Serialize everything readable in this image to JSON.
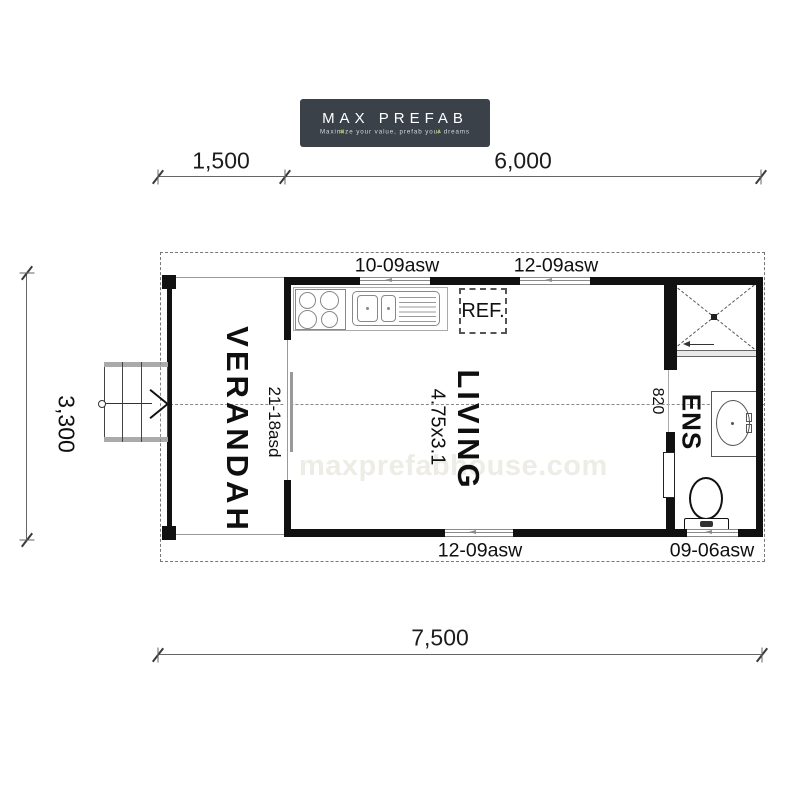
{
  "logo": {
    "title": "MAX PREFAB",
    "tagline": "Maximize your value, prefab your dreams",
    "bg_color": "#3a4149",
    "text_color": "#ffffff",
    "accent_color": "#8fc73e"
  },
  "dimensions": {
    "top_left": "1,500",
    "top_right": "6,000",
    "left_side": "3,300",
    "bottom": "7,500"
  },
  "rooms": {
    "verandah": "VERANDAH",
    "living": "LIVING",
    "living_size": "4.75x3.1",
    "ens": "ENS"
  },
  "openings": {
    "window_top_left": "10-09asw",
    "window_top_right": "12-09asw",
    "window_bottom_middle": "12-09asw",
    "window_bottom_right": "09-06asw",
    "sliding_door_verandah": "21-18asd",
    "ens_door_width": "820"
  },
  "fixtures": {
    "fridge_label": "REF."
  },
  "watermark": "maxprefabhouse.com",
  "colors": {
    "wall": "#111111",
    "dimension_line": "#666666",
    "dashed_outline": "#777777",
    "fixture_line": "#888888",
    "watermark_text": "#edece5"
  }
}
